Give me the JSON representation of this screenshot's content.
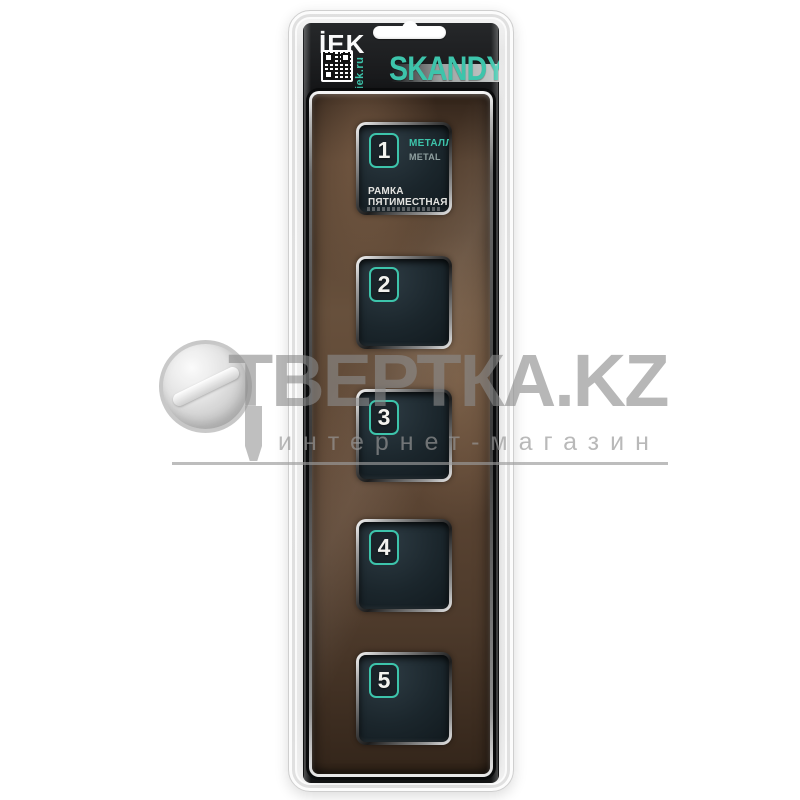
{
  "header": {
    "brand": "İEK",
    "site_url": "iek.ru",
    "series": "SKANDY"
  },
  "frame": {
    "openings": [
      {
        "number": "1"
      },
      {
        "number": "2"
      },
      {
        "number": "3"
      },
      {
        "number": "4"
      },
      {
        "number": "5"
      }
    ],
    "label": {
      "material_ru": "МЕТАЛЛ",
      "material_en": "METAL",
      "product_name": "РАМКА ПЯТИМЕСТНАЯ"
    }
  },
  "watermark": {
    "site_name": "ТВЕРТКА.KZ",
    "tagline": "интернет-магазин"
  },
  "colors": {
    "accent_teal": "#3dc4ab",
    "frame_brown": "#57422f",
    "card_black": "#141414",
    "watermark_gray": "#8a8a8a"
  }
}
